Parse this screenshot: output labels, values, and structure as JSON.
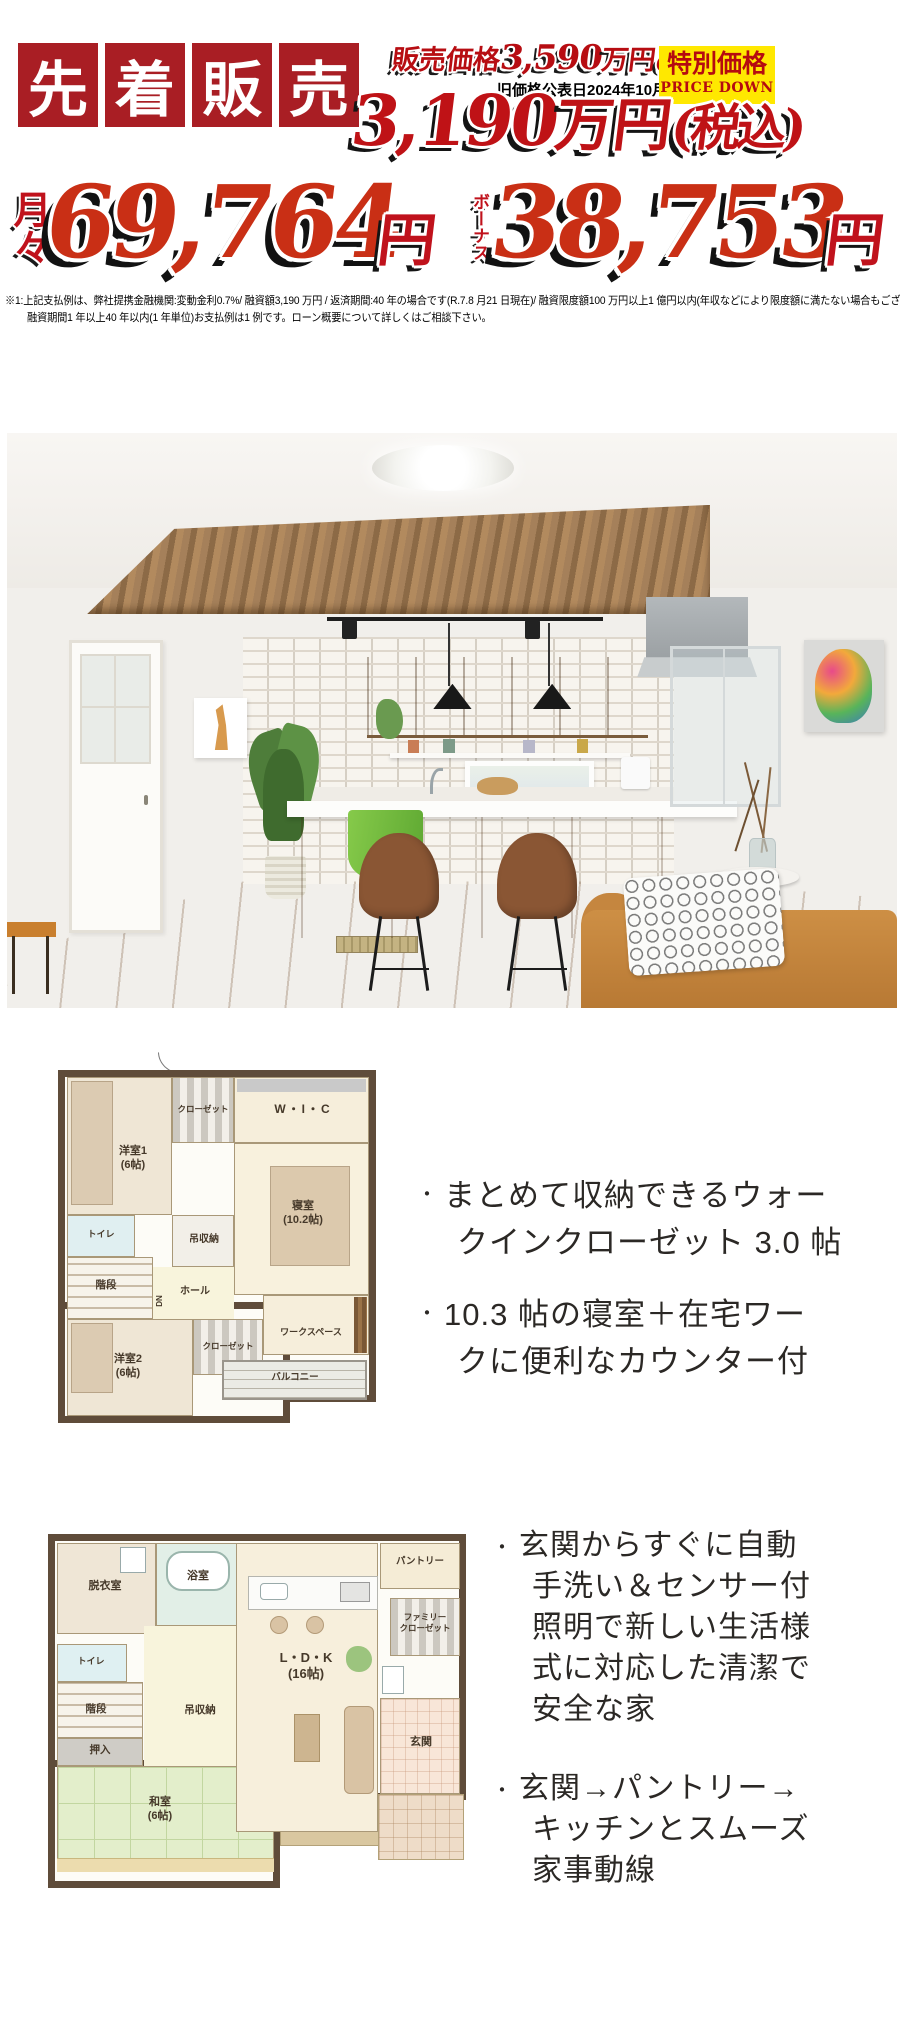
{
  "banner": {
    "chars": [
      "先",
      "着",
      "販",
      "売"
    ],
    "bg": "#a91e24"
  },
  "pricing": {
    "old_price_prefix": "販売価格",
    "old_price_value": "3,590",
    "old_price_suffix": "万円",
    "old_price_tax": "(税込)",
    "old_price_date": "旧価格公表日2024年10月1日",
    "badge_title": "特別価格",
    "badge_subtitle": "PRICE DOWN",
    "new_price_value": "3,190",
    "new_price_unit": "万円",
    "new_price_tax": "(税込)"
  },
  "payment": {
    "monthly_label": "月々",
    "monthly_value": "69,764",
    "monthly_unit": "円",
    "bonus_label": "ボーナス",
    "bonus_value": "38,753",
    "bonus_unit": "円"
  },
  "disclaimer": {
    "line1": "※1:上記支払例は、弊社提携金融機関:変動金利0.7%/ 融資額3,190 万円 / 返済期間:40 年の場合です(R.7.8 月21 日現在)/ 融資限度額100 万円以上1 億円以内(年収などにより限度額に満たない場合もございます)",
    "line2": "融資期間1 年以上40 年以内(1 年単位)お支払例は1 例です。ローン概要について詳しくはご相談下さい。"
  },
  "photo": {
    "description": "木目天井とアイランドキッチンのLDK内観写真"
  },
  "bullets": {
    "marker": "・"
  },
  "plan2f": {
    "rooms": [
      {
        "label": "洋室1\n(6帖)"
      },
      {
        "label": "クローゼット"
      },
      {
        "label": "W・I・C"
      },
      {
        "label": "寝室\n(10.2帖)"
      },
      {
        "label": "トイレ"
      },
      {
        "label": "階段"
      },
      {
        "label": "DN"
      },
      {
        "label": "吊収納"
      },
      {
        "label": "ホール"
      },
      {
        "label": "洋室2\n(6帖)"
      },
      {
        "label": "クローゼット"
      },
      {
        "label": "ワークスペース"
      },
      {
        "label": "バルコニー"
      }
    ]
  },
  "features_upper": {
    "items": [
      {
        "lines": [
          "まとめて収納できるウォー",
          "クインクローゼット 3.0 帖"
        ]
      },
      {
        "lines": [
          "10.3 帖の寝室＋在宅ワー",
          "クに便利なカウンター付"
        ]
      }
    ]
  },
  "plan1f": {
    "rooms": [
      {
        "label": "脱衣室"
      },
      {
        "label": "浴室"
      },
      {
        "label": "トイレ"
      },
      {
        "label": "階段"
      },
      {
        "label": "押入"
      },
      {
        "label": "和室\n(6帖)"
      },
      {
        "label": "吊収納"
      },
      {
        "label": "L・D・K\n(16帖)"
      },
      {
        "label": "パントリー"
      },
      {
        "label": "ファミリー\nクローゼット"
      },
      {
        "label": "玄関"
      }
    ]
  },
  "features_lower": {
    "items": [
      {
        "lines": [
          "玄関からすぐに自動",
          "手洗い＆センサー付",
          "照明で新しい生活様",
          "式に対応した清潔で",
          "安全な家"
        ]
      },
      {
        "lines": [
          "玄関→パントリー→",
          "キッチンとスムーズ",
          "家事動線"
        ]
      }
    ]
  }
}
